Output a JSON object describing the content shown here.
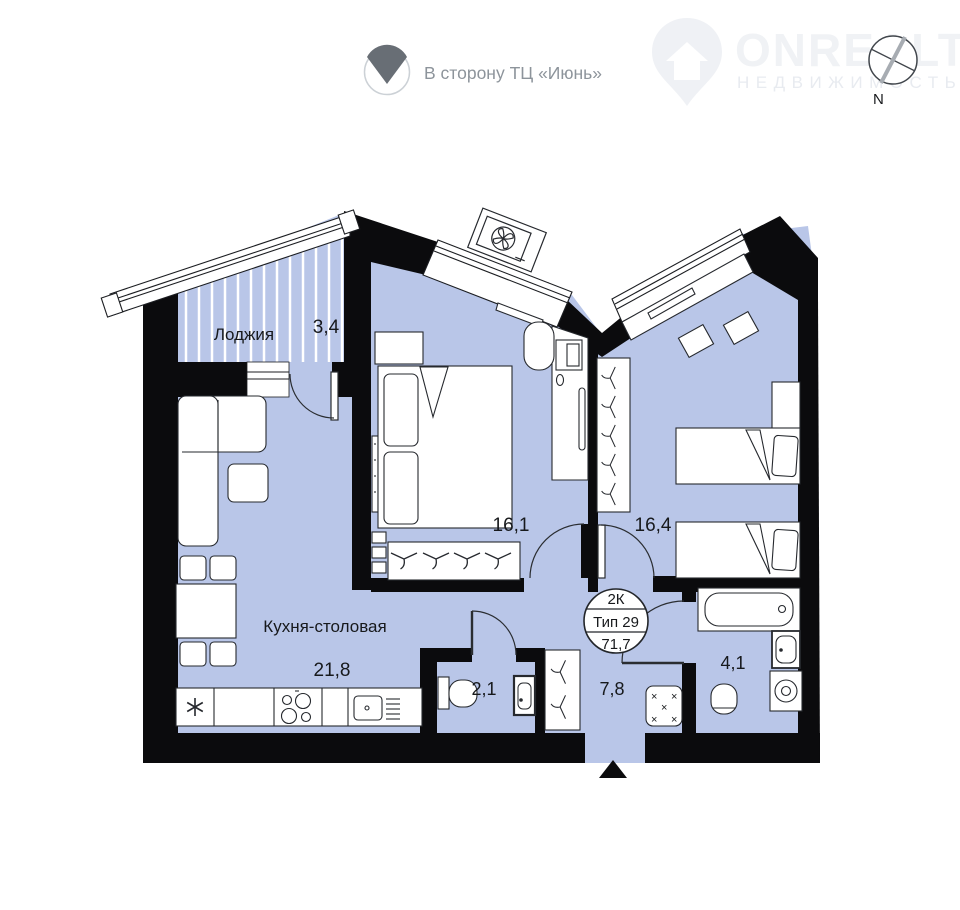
{
  "header": {
    "direction_label": "В сторону ТЦ «Июнь»",
    "compass_n": "N",
    "logo_title": "ONREALT",
    "logo_subtitle": "НЕДВИЖИМОСТЬ"
  },
  "stamp": {
    "rooms_type": "2К",
    "plan_type": "Тип 29",
    "total_area": "71,7"
  },
  "rooms": {
    "loggia": {
      "label": "Лоджия",
      "area": "3,4"
    },
    "bedroom1": {
      "area": "16,1"
    },
    "bedroom2": {
      "area": "16,4"
    },
    "kitchen": {
      "label": "Кухня-столовая",
      "area": "21,8"
    },
    "wc": {
      "area": "2,1"
    },
    "hallway": {
      "area": "7,8"
    },
    "bathroom": {
      "area": "4,1"
    }
  },
  "colors": {
    "room_fill": "#b9c6e8",
    "wall": "#0b0b0d",
    "furniture_line": "#26292e",
    "text": "#17191c",
    "muted_text": "#8d949b",
    "watermark": "#f0f2f5",
    "compass_thick_line": "#a7acb2"
  }
}
